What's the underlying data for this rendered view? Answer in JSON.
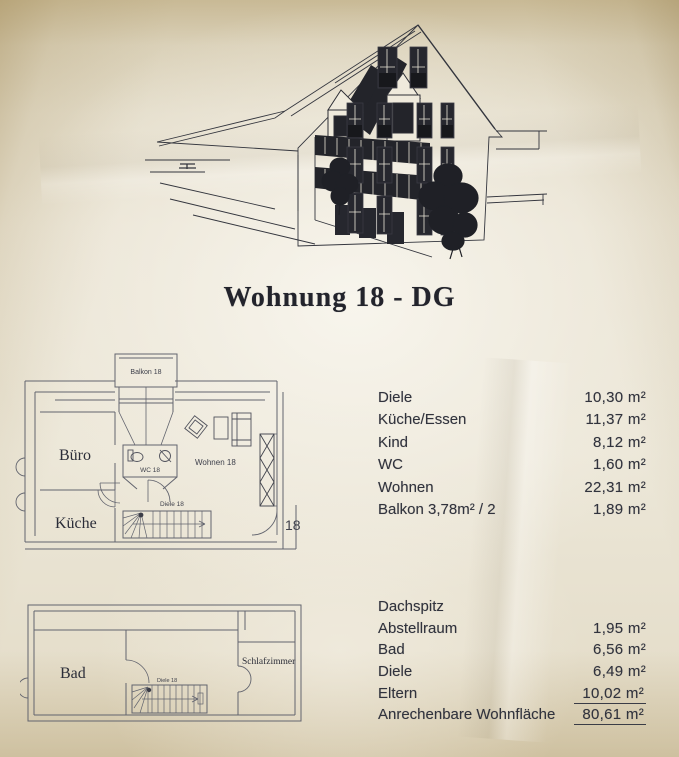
{
  "page": {
    "title": "Wohnung 18 - DG"
  },
  "plan_dg": {
    "balkon": "Balkon 18",
    "buero": "Büro",
    "kueche": "Küche",
    "wc": "WC 18",
    "wohnen": "Wohnen 18",
    "diele": "Diele 18",
    "unit": "18"
  },
  "plan_dachspitz": {
    "bad": "Bad",
    "diele": "Diele 18",
    "schlafzimmer": "Schlafzimmer"
  },
  "areas_dg": {
    "rows": [
      {
        "label": "Diele",
        "value": "10,30 m²"
      },
      {
        "label": "Küche/Essen",
        "value": "11,37 m²"
      },
      {
        "label": "Kind",
        "value": "8,12 m²"
      },
      {
        "label": "WC",
        "value": "1,60 m²"
      },
      {
        "label": "Wohnen",
        "value": "22,31 m²"
      },
      {
        "label": "Balkon 3,78m² / 2",
        "value": "1,89 m²"
      }
    ]
  },
  "areas_dachspitz": {
    "header": "Dachspitz",
    "rows": [
      {
        "label": "Abstellraum",
        "value": "1,95 m²"
      },
      {
        "label": "Bad",
        "value": "6,56 m²"
      },
      {
        "label": "Diele",
        "value": "6,49 m²"
      },
      {
        "label": "Eltern",
        "value": "10,02 m²"
      },
      {
        "label": "Anrechenbare Wohnfläche",
        "value": "80,61 m²"
      }
    ]
  },
  "colors": {
    "paper": "#ece7d8",
    "paper_edge": "#c9ba95",
    "ink": "#31333d",
    "plan_line": "#62646e",
    "sketch_dark": "#202127"
  }
}
